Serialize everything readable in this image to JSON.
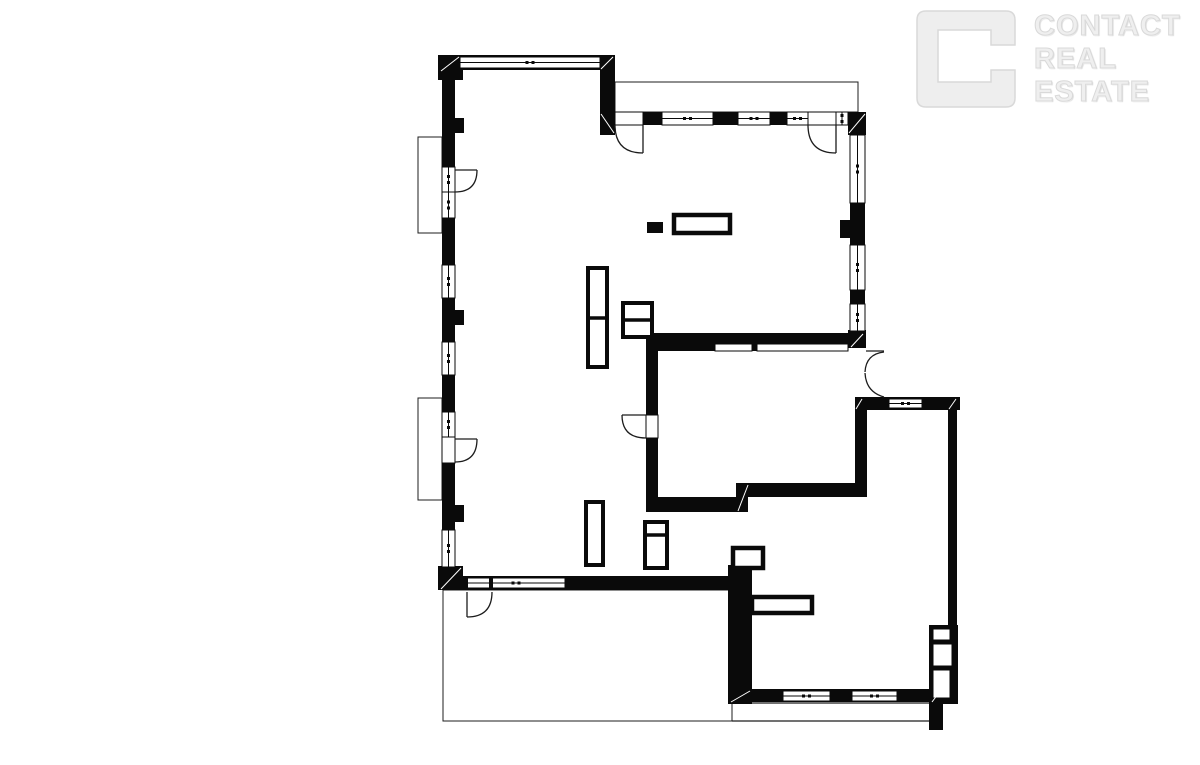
{
  "page": {
    "width": 1200,
    "height": 760,
    "background": "#ffffff"
  },
  "watermark_logo": {
    "brand_lines": [
      "CONTACT",
      "REAL",
      "ESTATE"
    ],
    "fill_color": "#efefef",
    "edge_color": "#d9d9d9"
  },
  "floor_plan": {
    "ink": "#0a0a0a",
    "thin_line": "#1c1c1c",
    "seam_color": "#ffffff",
    "walls": [
      [
        438,
        55,
        177,
        15
      ],
      [
        438,
        55,
        25,
        25
      ],
      [
        600,
        55,
        15,
        80
      ],
      [
        442,
        55,
        13,
        535
      ],
      [
        455,
        118,
        9,
        15
      ],
      [
        455,
        310,
        9,
        15
      ],
      [
        455,
        505,
        9,
        17
      ],
      [
        438,
        566,
        25,
        24
      ],
      [
        442,
        576,
        290,
        14
      ],
      [
        613,
        112,
        235,
        13
      ],
      [
        848,
        112,
        18,
        23
      ],
      [
        850,
        112,
        15,
        236
      ],
      [
        840,
        220,
        12,
        18
      ],
      [
        848,
        330,
        18,
        18
      ],
      [
        646,
        333,
        206,
        11
      ],
      [
        646,
        344,
        69,
        7
      ],
      [
        752,
        344,
        6,
        7
      ],
      [
        646,
        333,
        12,
        82
      ],
      [
        646,
        438,
        12,
        74
      ],
      [
        646,
        497,
        99,
        15
      ],
      [
        736,
        483,
        12,
        29
      ],
      [
        745,
        483,
        122,
        14
      ],
      [
        855,
        397,
        105,
        13
      ],
      [
        855,
        398,
        12,
        99
      ],
      [
        948,
        410,
        9,
        215
      ],
      [
        929,
        625,
        29,
        79
      ],
      [
        730,
        689,
        214,
        13
      ],
      [
        929,
        688,
        14,
        42
      ],
      [
        728,
        565,
        24,
        139
      ]
    ],
    "windows": [
      [
        460,
        57,
        140,
        11
      ],
      [
        442,
        167,
        13,
        25
      ],
      [
        442,
        192,
        13,
        26
      ],
      [
        442,
        265,
        13,
        33
      ],
      [
        442,
        342,
        13,
        33
      ],
      [
        442,
        412,
        13,
        25
      ],
      [
        442,
        530,
        13,
        37
      ],
      [
        662,
        112,
        51,
        13
      ],
      [
        738,
        112,
        32,
        13
      ],
      [
        787,
        112,
        21,
        13
      ],
      [
        836,
        112,
        12,
        13
      ],
      [
        850,
        135,
        15,
        68
      ],
      [
        850,
        245,
        15,
        45
      ],
      [
        850,
        304,
        15,
        27
      ],
      [
        889,
        399,
        33,
        9
      ],
      [
        467,
        578,
        98,
        10
      ],
      [
        783,
        691,
        47,
        10
      ],
      [
        852,
        691,
        45,
        10
      ]
    ],
    "openings": [
      [
        615,
        112,
        28,
        13
      ],
      [
        808,
        112,
        28,
        13
      ],
      [
        442,
        437,
        13,
        26
      ],
      [
        646,
        415,
        12,
        23
      ],
      [
        715,
        344,
        37,
        7
      ],
      [
        757,
        344,
        91,
        7
      ],
      [
        933,
        629,
        17,
        11
      ],
      [
        933,
        644,
        19,
        22
      ],
      [
        933,
        670,
        17,
        28
      ]
    ],
    "solids": [
      [
        647,
        222,
        16,
        11
      ],
      [
        586,
        502,
        10,
        12
      ],
      [
        464,
        577,
        4,
        13
      ],
      [
        489,
        577,
        4,
        13
      ]
    ],
    "furniture": [
      {
        "x": 674,
        "y": 215,
        "w": 56,
        "h": 18,
        "sw": 4.5
      },
      {
        "x": 588,
        "y": 268,
        "w": 19,
        "h": 99,
        "sw": 4,
        "div": [
          588,
          318,
          607,
          318
        ]
      },
      {
        "x": 623,
        "y": 303,
        "w": 29,
        "h": 34,
        "sw": 4,
        "div": [
          623,
          320,
          652,
          320
        ]
      },
      {
        "x": 586,
        "y": 502,
        "w": 17,
        "h": 63,
        "sw": 4
      },
      {
        "x": 645,
        "y": 522,
        "w": 22,
        "h": 46,
        "sw": 4,
        "div": [
          645,
          535,
          667,
          535
        ]
      },
      {
        "x": 733,
        "y": 548,
        "w": 30,
        "h": 20,
        "sw": 4.5
      },
      {
        "x": 752,
        "y": 597,
        "w": 60,
        "h": 16,
        "sw": 4.5
      }
    ],
    "outlines": [
      [
        418,
        137,
        24,
        96
      ],
      [
        418,
        398,
        24,
        102
      ],
      [
        615,
        82,
        243,
        30
      ],
      [
        443,
        590,
        289,
        131
      ]
    ],
    "lines": [
      [
        752,
        703,
        929,
        703
      ],
      [
        732,
        721,
        929,
        721
      ],
      [
        866,
        351,
        884,
        351
      ]
    ],
    "doors": [
      "M455,170 L477,170 M477,170 Q477,192 455,192",
      "M455,439 L477,439 M477,439 Q477,462 455,462",
      "M643,125 L643,153 M615,125 Q615,153 643,153",
      "M836,125 L836,153 M808,125 Q808,153 836,153",
      "M646,415 L622,415 M622,415 Q622,438 646,438",
      "M467,592 L467,617 M467,617 Q492,617 492,592",
      "M884,352 Q866,354 865,372 M865,373 Q866,392 884,397"
    ],
    "seams": [
      [
        441,
        71,
        459,
        57
      ],
      [
        601,
        69,
        613,
        57
      ],
      [
        601,
        114,
        614,
        133
      ],
      [
        849,
        133,
        865,
        114
      ],
      [
        441,
        589,
        461,
        568
      ],
      [
        738,
        511,
        748,
        485
      ],
      [
        731,
        702,
        750,
        691
      ],
      [
        932,
        702,
        941,
        690
      ],
      [
        949,
        409,
        956,
        399
      ],
      [
        856,
        409,
        862,
        399
      ],
      [
        851,
        347,
        863,
        334
      ]
    ]
  }
}
